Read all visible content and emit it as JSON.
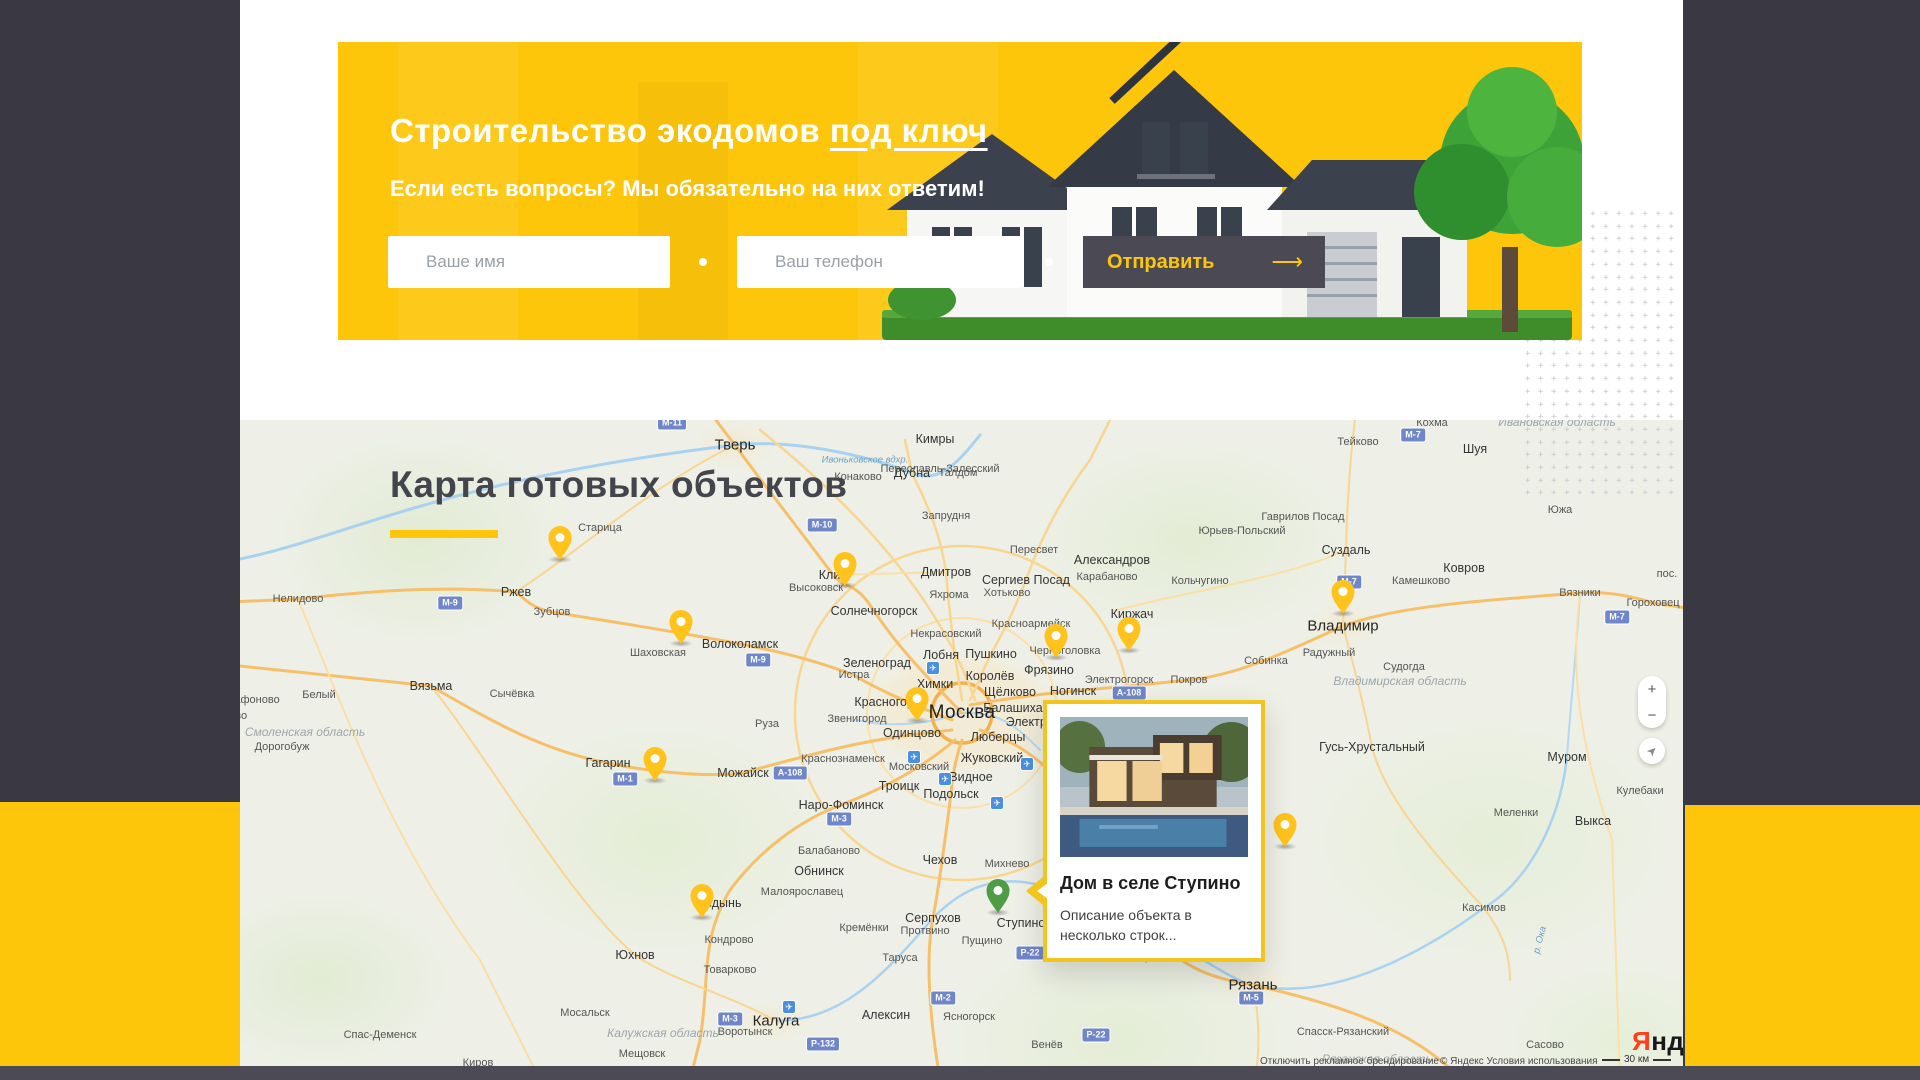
{
  "theme": {
    "yellow": "#fdc60b",
    "dark": "#3a3943",
    "footer": "#4c4b55",
    "pin_yellow": "#ffc31b",
    "pin_green": "#4e9d44"
  },
  "hero": {
    "title_main": "Строительство экодомов",
    "title_link": "под ключ",
    "subtitle": "Если есть вопросы? Мы обязательно на них ответим!",
    "name_placeholder": "Ваше имя",
    "phone_placeholder": "Ваш телефон",
    "submit_label": "Отправить",
    "submit_arrow": "⟶"
  },
  "map_section": {
    "heading": "Карта готовых объектов",
    "popup": {
      "title": "Дом в селе Ступино",
      "description": "Описание объекта в несколько строк..."
    },
    "controls": {
      "zoom_in": "+",
      "zoom_out": "−",
      "locate_icon": "➤"
    },
    "logo": {
      "first_letter": "Я",
      "rest": "ндекс"
    },
    "attribution_left": "Отключить рекламное брендирование",
    "attribution_right": "© Яндекс Условия использования",
    "scale_label": "30 км",
    "pins": [
      {
        "x": 560,
        "y": 560,
        "color": "yellow"
      },
      {
        "x": 845,
        "y": 586,
        "color": "yellow"
      },
      {
        "x": 681,
        "y": 644,
        "color": "yellow"
      },
      {
        "x": 1343,
        "y": 614,
        "color": "yellow"
      },
      {
        "x": 1056,
        "y": 658,
        "color": "yellow"
      },
      {
        "x": 1129,
        "y": 651,
        "color": "yellow"
      },
      {
        "x": 917,
        "y": 721,
        "color": "yellow"
      },
      {
        "x": 655,
        "y": 781,
        "color": "yellow"
      },
      {
        "x": 1285,
        "y": 847,
        "color": "yellow"
      },
      {
        "x": 702,
        "y": 918,
        "color": "yellow"
      },
      {
        "x": 998,
        "y": 913,
        "color": "green",
        "selected": true
      }
    ],
    "cities": [
      {
        "n": "Тверь",
        "x": 735,
        "y": 445,
        "s": 1
      },
      {
        "n": "Кимры",
        "x": 935,
        "y": 439,
        "s": 2
      },
      {
        "n": "Конаково",
        "x": 858,
        "y": 477,
        "s": 3
      },
      {
        "n": "Дубна",
        "x": 912,
        "y": 473,
        "s": 2
      },
      {
        "n": "Талдом",
        "x": 958,
        "y": 473,
        "s": 3
      },
      {
        "n": "Запрудня",
        "x": 946,
        "y": 516,
        "s": 3
      },
      {
        "n": "Переславль-Залесский",
        "x": 940,
        "y": 469,
        "s": 3
      },
      {
        "n": "Старица",
        "x": 600,
        "y": 528,
        "s": 3
      },
      {
        "n": "Ржев",
        "x": 516,
        "y": 592,
        "s": 2
      },
      {
        "n": "Зубцов",
        "x": 552,
        "y": 612,
        "s": 3
      },
      {
        "n": "Нелидово",
        "x": 298,
        "y": 599,
        "s": 3
      },
      {
        "n": "Белый",
        "x": 319,
        "y": 695,
        "s": 3
      },
      {
        "n": "Сычёвка",
        "x": 512,
        "y": 694,
        "s": 3
      },
      {
        "n": "Шаховская",
        "x": 658,
        "y": 653,
        "s": 3
      },
      {
        "n": "Волоколамск",
        "x": 740,
        "y": 644,
        "s": 2
      },
      {
        "n": "Высоковск",
        "x": 816,
        "y": 588,
        "s": 3
      },
      {
        "n": "Клин",
        "x": 833,
        "y": 575,
        "s": 2
      },
      {
        "n": "Солнечногорск",
        "x": 874,
        "y": 611,
        "s": 2
      },
      {
        "n": "Некрасовский",
        "x": 946,
        "y": 634,
        "s": 3
      },
      {
        "n": "Зеленоград",
        "x": 877,
        "y": 663,
        "s": 2
      },
      {
        "n": "Истра",
        "x": 854,
        "y": 675,
        "s": 3
      },
      {
        "n": "Лобня",
        "x": 941,
        "y": 655,
        "s": 2
      },
      {
        "n": "Пушкино",
        "x": 991,
        "y": 654,
        "s": 2
      },
      {
        "n": "Королёв",
        "x": 990,
        "y": 676,
        "s": 2
      },
      {
        "n": "Химки",
        "x": 935,
        "y": 684,
        "s": 2
      },
      {
        "n": "Щёлково",
        "x": 1010,
        "y": 692,
        "s": 2
      },
      {
        "n": "Балашиха",
        "x": 1013,
        "y": 708,
        "s": 2
      },
      {
        "n": "Электросталь",
        "x": 1046,
        "y": 722,
        "s": 2
      },
      {
        "n": "Красногорск",
        "x": 890,
        "y": 702,
        "s": 2
      },
      {
        "n": "Москва",
        "x": 962,
        "y": 713,
        "s": 0
      },
      {
        "n": "Звенигород",
        "x": 857,
        "y": 719,
        "s": 3
      },
      {
        "n": "Одинцово",
        "x": 912,
        "y": 733,
        "s": 2
      },
      {
        "n": "Люберцы",
        "x": 998,
        "y": 737,
        "s": 2
      },
      {
        "n": "Жуковский",
        "x": 992,
        "y": 758,
        "s": 2
      },
      {
        "n": "Московский",
        "x": 919,
        "y": 767,
        "s": 3
      },
      {
        "n": "Видное",
        "x": 971,
        "y": 777,
        "s": 2
      },
      {
        "n": "Подольск",
        "x": 951,
        "y": 794,
        "s": 2
      },
      {
        "n": "Троицк",
        "x": 899,
        "y": 786,
        "s": 2
      },
      {
        "n": "Краснознаменск",
        "x": 843,
        "y": 759,
        "s": 3
      },
      {
        "n": "Наро-Фоминск",
        "x": 841,
        "y": 805,
        "s": 2
      },
      {
        "n": "Балабаново",
        "x": 829,
        "y": 851,
        "s": 3
      },
      {
        "n": "Обнинск",
        "x": 819,
        "y": 871,
        "s": 2
      },
      {
        "n": "Малоярославец",
        "x": 802,
        "y": 892,
        "s": 3
      },
      {
        "n": "Чехов",
        "x": 940,
        "y": 860,
        "s": 2
      },
      {
        "n": "Михнево",
        "x": 1007,
        "y": 864,
        "s": 3
      },
      {
        "n": "Серпухов",
        "x": 933,
        "y": 918,
        "s": 2
      },
      {
        "n": "Кремёнки",
        "x": 864,
        "y": 928,
        "s": 3
      },
      {
        "n": "Протвино",
        "x": 925,
        "y": 931,
        "s": 3
      },
      {
        "n": "Пущино",
        "x": 982,
        "y": 941,
        "s": 3
      },
      {
        "n": "Таруса",
        "x": 900,
        "y": 958,
        "s": 3
      },
      {
        "n": "Алексин",
        "x": 886,
        "y": 1015,
        "s": 2
      },
      {
        "n": "Ясногорск",
        "x": 969,
        "y": 1017,
        "s": 3
      },
      {
        "n": "Венёв",
        "x": 1047,
        "y": 1045,
        "s": 3
      },
      {
        "n": "Воротынск",
        "x": 745,
        "y": 1032,
        "s": 3
      },
      {
        "n": "Товарково",
        "x": 730,
        "y": 970,
        "s": 3
      },
      {
        "n": "Кондрово",
        "x": 729,
        "y": 940,
        "s": 3
      },
      {
        "n": "Медынь",
        "x": 718,
        "y": 903,
        "s": 2
      },
      {
        "n": "Юхнов",
        "x": 635,
        "y": 955,
        "s": 2
      },
      {
        "n": "Мосальск",
        "x": 585,
        "y": 1013,
        "s": 3
      },
      {
        "n": "Мещовск",
        "x": 642,
        "y": 1054,
        "s": 3
      },
      {
        "n": "Спас-Деменск",
        "x": 380,
        "y": 1035,
        "s": 3
      },
      {
        "n": "Киров",
        "x": 478,
        "y": 1063,
        "s": 3
      },
      {
        "n": "Вязьма",
        "x": 431,
        "y": 686,
        "s": 2
      },
      {
        "n": "Сафоново",
        "x": 253,
        "y": 700,
        "s": 3
      },
      {
        "n": "Дорогобуж",
        "x": 282,
        "y": 747,
        "s": 3
      },
      {
        "n": "Ярцево",
        "x": 228,
        "y": 716,
        "s": 3
      },
      {
        "n": "Гагарин",
        "x": 608,
        "y": 763,
        "s": 2
      },
      {
        "n": "Можайск",
        "x": 743,
        "y": 773,
        "s": 2
      },
      {
        "n": "Руза",
        "x": 767,
        "y": 724,
        "s": 3
      },
      {
        "n": "Дмитров",
        "x": 946,
        "y": 572,
        "s": 2
      },
      {
        "n": "Яхрома",
        "x": 949,
        "y": 595,
        "s": 3
      },
      {
        "n": "Сергиев Посад",
        "x": 1026,
        "y": 580,
        "s": 2
      },
      {
        "n": "Хотьково",
        "x": 1007,
        "y": 593,
        "s": 3
      },
      {
        "n": "Пересвет",
        "x": 1034,
        "y": 550,
        "s": 3
      },
      {
        "n": "Красноармейск",
        "x": 1031,
        "y": 624,
        "s": 3
      },
      {
        "n": "Фрязино",
        "x": 1049,
        "y": 670,
        "s": 2
      },
      {
        "n": "Черноголовка",
        "x": 1065,
        "y": 651,
        "s": 3
      },
      {
        "n": "Ногинск",
        "x": 1073,
        "y": 691,
        "s": 2
      },
      {
        "n": "Электрогорск",
        "x": 1119,
        "y": 680,
        "s": 3
      },
      {
        "n": "Покров",
        "x": 1189,
        "y": 680,
        "s": 3
      },
      {
        "n": "Киржач",
        "x": 1132,
        "y": 614,
        "s": 2
      },
      {
        "n": "Александров",
        "x": 1112,
        "y": 560,
        "s": 2
      },
      {
        "n": "Карабаново",
        "x": 1107,
        "y": 577,
        "s": 3
      },
      {
        "n": "Кольчугино",
        "x": 1200,
        "y": 581,
        "s": 3
      },
      {
        "n": "Юрьев-Польский",
        "x": 1242,
        "y": 531,
        "s": 3
      },
      {
        "n": "Гаврилов Посад",
        "x": 1303,
        "y": 517,
        "s": 3
      },
      {
        "n": "Суздаль",
        "x": 1346,
        "y": 550,
        "s": 2
      },
      {
        "n": "Камешково",
        "x": 1421,
        "y": 581,
        "s": 3
      },
      {
        "n": "Ковров",
        "x": 1464,
        "y": 568,
        "s": 2
      },
      {
        "n": "Вязники",
        "x": 1580,
        "y": 593,
        "s": 3
      },
      {
        "n": "Гороховец",
        "x": 1653,
        "y": 603,
        "s": 3
      },
      {
        "n": "пос.",
        "x": 1667,
        "y": 574,
        "s": 3
      },
      {
        "n": "Тейково",
        "x": 1358,
        "y": 442,
        "s": 3
      },
      {
        "n": "Кохма",
        "x": 1432,
        "y": 423,
        "s": 3
      },
      {
        "n": "Шуя",
        "x": 1475,
        "y": 449,
        "s": 2
      },
      {
        "n": "Южа",
        "x": 1560,
        "y": 510,
        "s": 3
      },
      {
        "n": "Собинка",
        "x": 1266,
        "y": 661,
        "s": 3
      },
      {
        "n": "Радужный",
        "x": 1329,
        "y": 653,
        "s": 3
      },
      {
        "n": "Судогда",
        "x": 1404,
        "y": 667,
        "s": 3
      },
      {
        "n": "Гусь-Хрустальный",
        "x": 1372,
        "y": 747,
        "s": 2
      },
      {
        "n": "Муром",
        "x": 1567,
        "y": 757,
        "s": 2
      },
      {
        "n": "Меленки",
        "x": 1516,
        "y": 813,
        "s": 3
      },
      {
        "n": "Выкса",
        "x": 1593,
        "y": 821,
        "s": 2
      },
      {
        "n": "Кулебаки",
        "x": 1640,
        "y": 791,
        "s": 3
      },
      {
        "n": "Касимов",
        "x": 1484,
        "y": 908,
        "s": 3
      },
      {
        "n": "Сасово",
        "x": 1545,
        "y": 1045,
        "s": 3
      },
      {
        "n": "Спасск-Рязанский",
        "x": 1343,
        "y": 1032,
        "s": 3
      },
      {
        "n": "Зарайск",
        "x": 1153,
        "y": 957,
        "s": 3
      },
      {
        "n": "Рыбное",
        "x": 1220,
        "y": 957,
        "s": 3
      },
      {
        "n": "Рязань",
        "x": 1253,
        "y": 985,
        "s": 1
      },
      {
        "n": "Калуга",
        "x": 776,
        "y": 1021,
        "s": 1
      },
      {
        "n": "Владимир",
        "x": 1343,
        "y": 626,
        "s": 1
      },
      {
        "n": "Ступино",
        "x": 1021,
        "y": 923,
        "s": 2
      }
    ],
    "regions": [
      {
        "n": "Смоленская область",
        "x": 305,
        "y": 732
      },
      {
        "n": "Калужская область",
        "x": 663,
        "y": 1033
      },
      {
        "n": "Рязанская область",
        "x": 1377,
        "y": 1059
      },
      {
        "n": "Владимирская область",
        "x": 1400,
        "y": 681
      },
      {
        "n": "Ивановская область",
        "x": 1557,
        "y": 422
      }
    ],
    "waters": [
      {
        "n": "Ивоньковское вдхр.",
        "x": 865,
        "y": 460,
        "rot": 0
      },
      {
        "n": "р. Ока",
        "x": 1540,
        "y": 940,
        "rot": -75
      }
    ],
    "road_badges": [
      {
        "n": "М-11",
        "x": 672,
        "y": 423
      },
      {
        "n": "М-10",
        "x": 822,
        "y": 525
      },
      {
        "n": "М-9",
        "x": 450,
        "y": 603
      },
      {
        "n": "М-9",
        "x": 758,
        "y": 660
      },
      {
        "n": "М-1",
        "x": 625,
        "y": 779
      },
      {
        "n": "М-3",
        "x": 839,
        "y": 819
      },
      {
        "n": "М-3",
        "x": 730,
        "y": 1019
      },
      {
        "n": "М-2",
        "x": 943,
        "y": 998
      },
      {
        "n": "М-5",
        "x": 1251,
        "y": 998
      },
      {
        "n": "М-7",
        "x": 1349,
        "y": 582
      },
      {
        "n": "М-7",
        "x": 1413,
        "y": 435
      },
      {
        "n": "М-7",
        "x": 1617,
        "y": 617
      },
      {
        "n": "А-108",
        "x": 790,
        "y": 773
      },
      {
        "n": "А-108",
        "x": 1129,
        "y": 693
      },
      {
        "n": "Р-132",
        "x": 823,
        "y": 1044
      },
      {
        "n": "Р-22",
        "x": 1030,
        "y": 953
      },
      {
        "n": "Р-22",
        "x": 1096,
        "y": 1035
      }
    ],
    "airports": [
      {
        "x": 933,
        "y": 668
      },
      {
        "x": 914,
        "y": 757
      },
      {
        "x": 945,
        "y": 779
      },
      {
        "x": 997,
        "y": 803
      },
      {
        "x": 789,
        "y": 1007
      },
      {
        "x": 1027,
        "y": 764
      }
    ]
  }
}
